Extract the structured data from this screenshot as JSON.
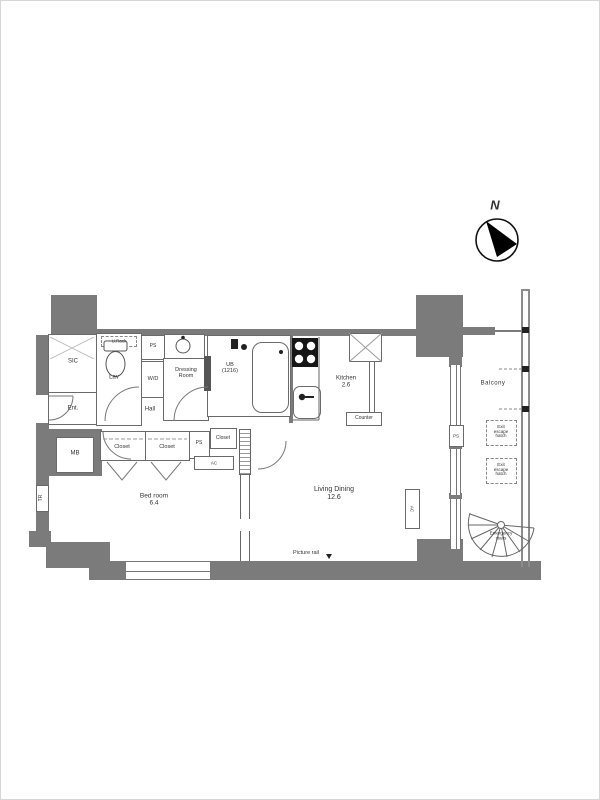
{
  "colors": {
    "wall": "#7b7b7b",
    "line": "#666666",
    "text": "#333333"
  },
  "compass": {
    "north": "N"
  },
  "rooms": {
    "sic": "SIC",
    "ent": "Ent.",
    "hall": "Hall",
    "mb": "MB",
    "tr": "TR",
    "u_rack": "U.Rack",
    "lav": "Lav",
    "ps_top": "PS",
    "wd": "W/D",
    "dressing1": "Dressing",
    "dressing2": "Room",
    "ub1": "UB",
    "ub2": "(1216)",
    "closet": "Closet",
    "ps_mid": "PS",
    "closet_small": "Closet",
    "ac": "AC",
    "bedroom": "Bed room",
    "bedroom_size": "6.4",
    "kitchen": "Kitchen",
    "kitchen_size": "2.6",
    "counter": "Counter",
    "living": "Living Dining",
    "living_size": "12.6",
    "picture_rail": "Picture rail",
    "balcony": "Balcony",
    "ps_balcony": "PS",
    "hatch1": "Exit",
    "hatch2": "escape",
    "hatch3": "hatch",
    "stairs1": "Emergency",
    "stairs2": "stairs"
  }
}
